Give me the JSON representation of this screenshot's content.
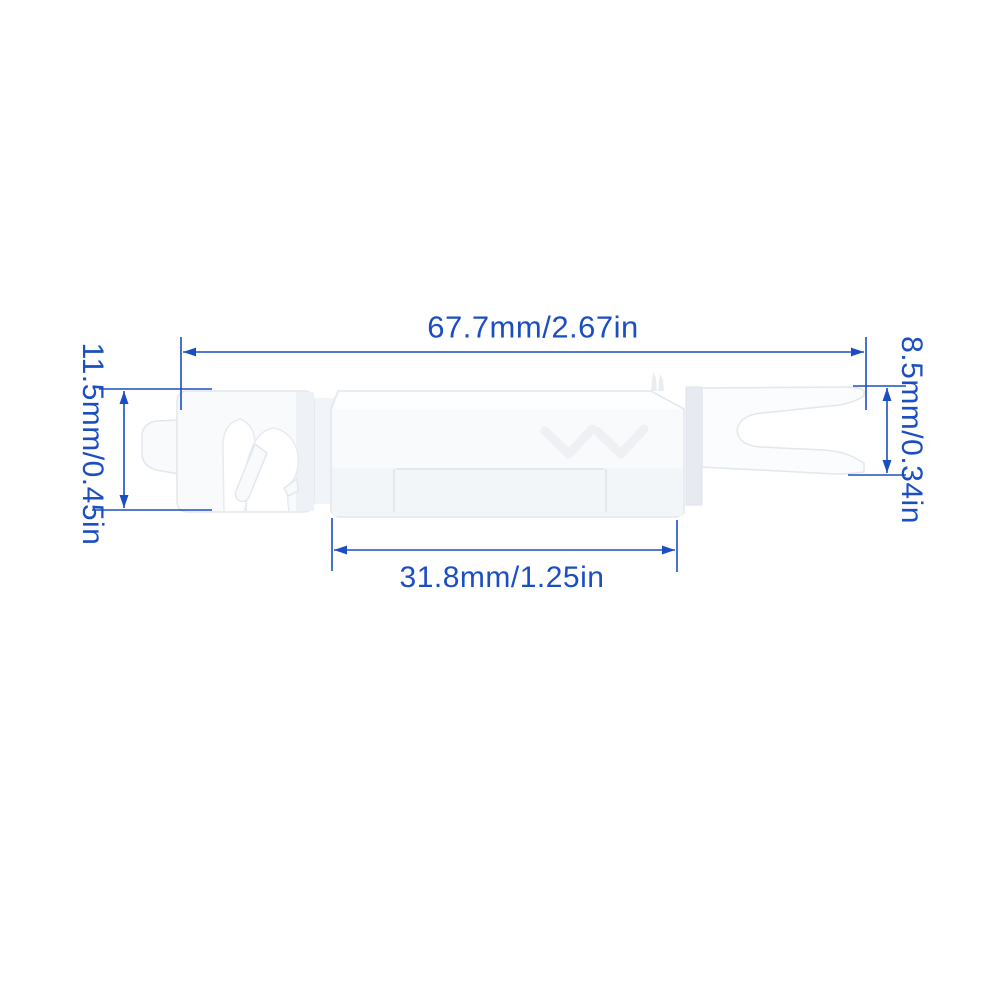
{
  "diagram": {
    "type": "product-dimension-diagram",
    "background_color": "#ffffff",
    "accent_color": "#1b4ec2",
    "part": {
      "name": "white-plastic-panel-clip",
      "base_color": "#f8fafc"
    },
    "dimensions": {
      "top": {
        "label": "67.7mm/2.67in",
        "value_mm": 67.7,
        "value_in": 2.67,
        "orientation": "horizontal"
      },
      "left": {
        "label": "11.5mm/0.45in",
        "value_mm": 11.5,
        "value_in": 0.45,
        "orientation": "vertical"
      },
      "right": {
        "label": "8.5mm/0.34in",
        "value_mm": 8.5,
        "value_in": 0.34,
        "orientation": "vertical"
      },
      "bottom": {
        "label": "31.8mm/1.25in",
        "value_mm": 31.8,
        "value_in": 1.25,
        "orientation": "horizontal"
      }
    }
  }
}
